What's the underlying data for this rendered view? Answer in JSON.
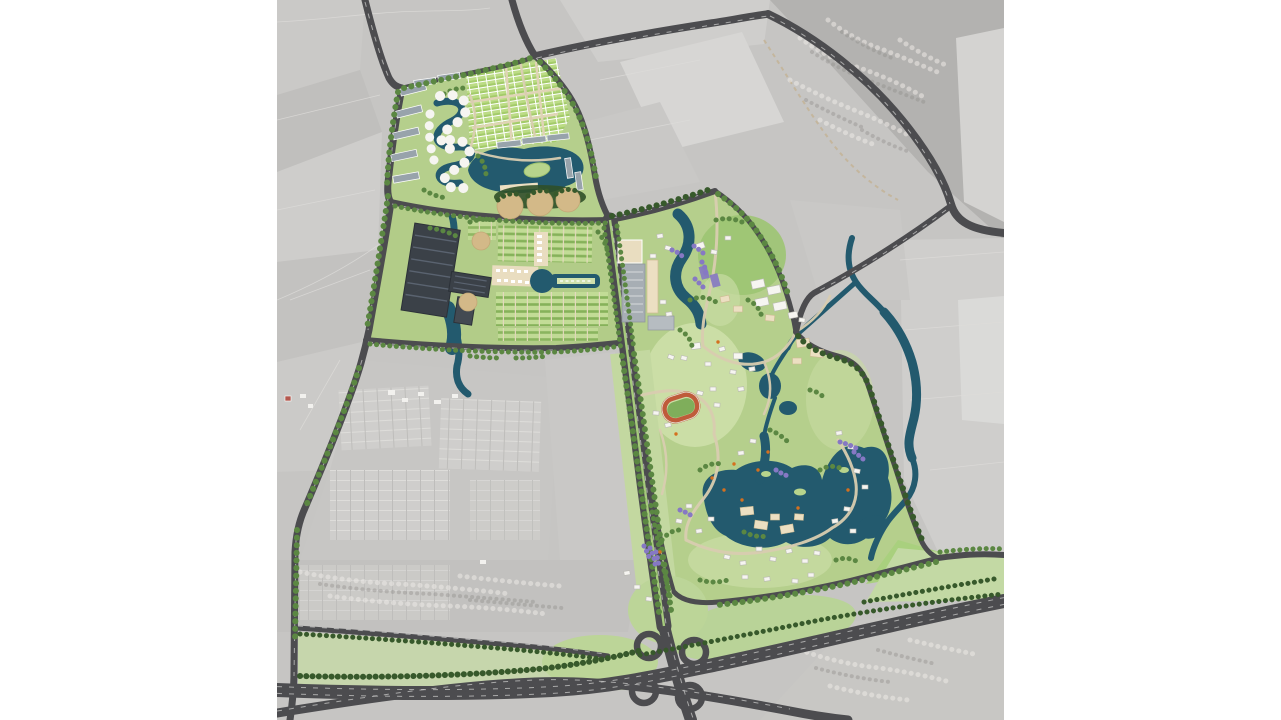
{
  "scene": {
    "kind": "aerial-masterplan-map",
    "canvas": {
      "width": 1281,
      "height": 720
    },
    "map_bounds_px": {
      "left": 277,
      "top": 0,
      "right": 1004,
      "bottom": 720
    }
  },
  "palette": {
    "page_bg": "#ffffff",
    "satellite_base": "#c6c5c3",
    "satellite_light": "#d6d5d3",
    "satellite_lighter": "#dedddb",
    "satellite_dark": "#b3b2b0",
    "road": "#4c4c4f",
    "road_line": "#d2d2d0",
    "water": "#235a6e",
    "green_ground": "#b5cf8c",
    "green_pale": "#cfe0aa",
    "green_bright": "#9cc472",
    "green_buffer": "#c3d8a0",
    "tree": "#5b8742",
    "tree_dark": "#37592b",
    "villa_green": "#bcdc86",
    "orchard_base": "#c2dc96",
    "orchard_row": "#86b25a",
    "tan": "#d9cdb0",
    "tan_light": "#e9ddc0",
    "mound_tan": "#d3b988",
    "building_white": "#f6f5f1",
    "building_beige": "#ecdfc2",
    "building_gray": "#98a3ab",
    "parking_gray": "#a7aeb4",
    "factory_dark": "#3b4148",
    "factory_line": "#5a6370",
    "track_red": "#bf5b3a",
    "track_infield": "#7fae5b",
    "purple_tree": "#8678c4",
    "orange_accent": "#d4701f",
    "red_roof": "#b4584e",
    "dirt_path": "#c3b194"
  },
  "features": {
    "basemap": "grayscale-satellite-basemap",
    "parcels": [
      {
        "id": "north-residential",
        "name": "north-residential-parcel"
      },
      {
        "id": "central-industrial",
        "name": "central-industrial-orchard-parcel"
      },
      {
        "id": "east-campus",
        "name": "east-campus-parkland-parcel"
      }
    ],
    "water_bodies": [
      "north-lake",
      "s-curve-canal",
      "industrial-canal",
      "keyhole-pond",
      "serpentine-pond",
      "campus-lakes",
      "river-corridor"
    ],
    "roads": [
      "northwest-approach-road",
      "west-boundary-road",
      "north-boundary-road",
      "northeast-arc-highway",
      "diagonal-link-road",
      "central-boulevard",
      "south-cross-road",
      "service-road",
      "south-highway",
      "south-frontage-road",
      "southeast-exit-road"
    ],
    "interchange": {
      "name": "cloverleaf-interchange",
      "loops": 4
    },
    "landmarks": [
      "running-track",
      "factory-sheds",
      "parking-court",
      "villa-grid",
      "circular-villa-cluster",
      "apartment-slabs",
      "tan-mounds",
      "esplanade",
      "purple-groves",
      "great-lawn-hill"
    ]
  }
}
